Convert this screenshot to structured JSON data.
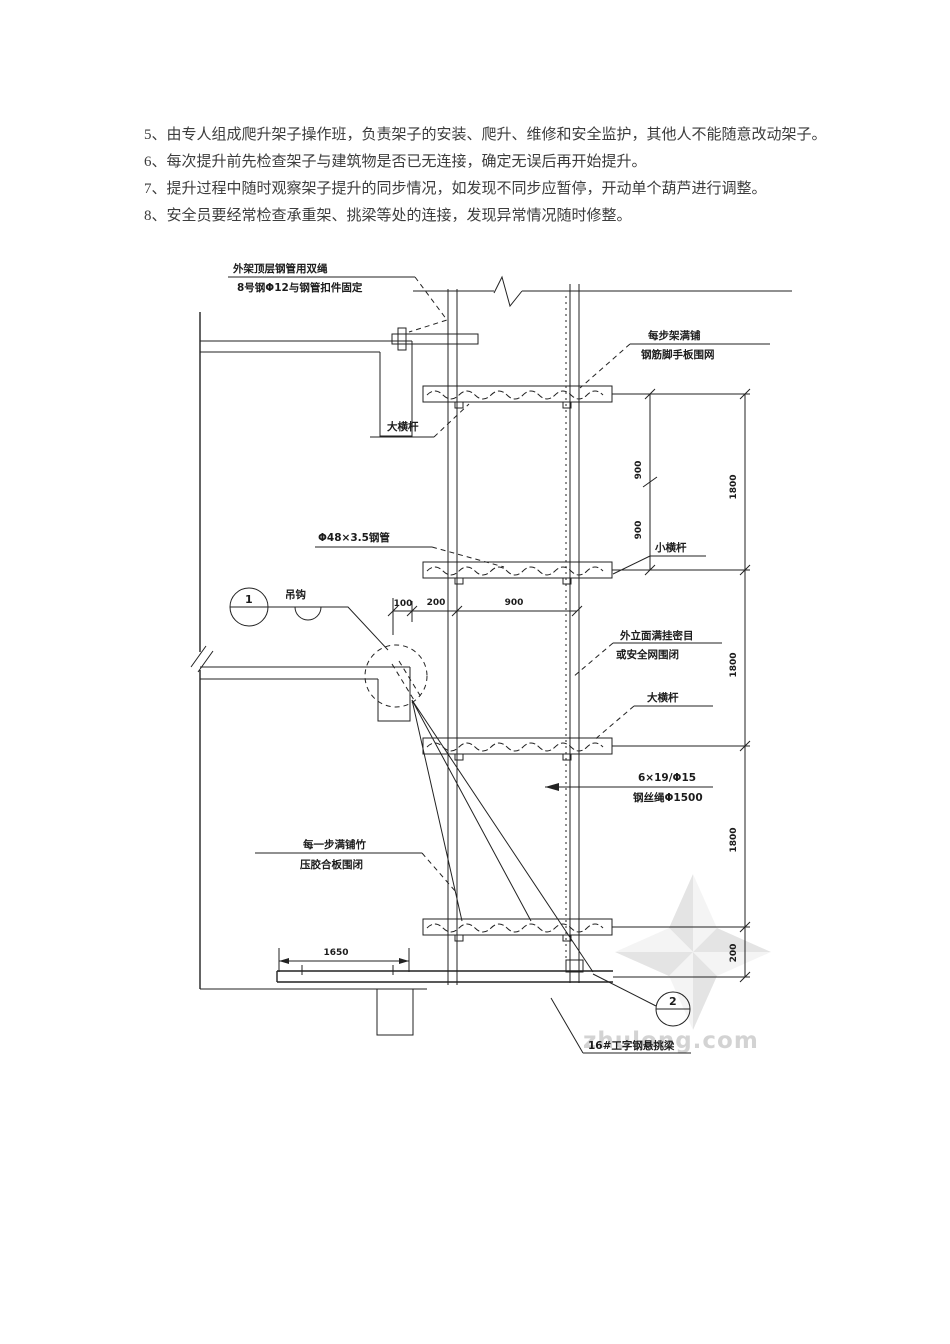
{
  "document": {
    "paragraphs": [
      "5、由专人组成爬升架子操作班，负责架子的安装、爬升、维修和安全监护，其他人不能随意改动架子。",
      "6、每次提升前先检查架子与建筑物是否已无连接，确定无误后再开始提升。",
      "7、提升过程中随时观察架子提升的同步情况，如发现不同步应暂停，开动单个葫芦进行调整。",
      "8、安全员要经常检查承重架、挑梁等处的连接，发现异常情况随时修整。"
    ]
  },
  "drawing": {
    "notes": {
      "anchor_l1": "外架顶层钢管用双绳",
      "anchor_l2": "8号钢Φ12与钢管扣件固定",
      "deck_l1": "每步架满铺",
      "deck_l2": "钢筋脚手板围网",
      "big_ledger": "大横杆",
      "pipe": "Φ48×3.5钢管",
      "hook": "吊钩",
      "small_ledger": "小横杆",
      "facade_l1": "外立面满挂密目",
      "facade_l2": "或安全网围闭",
      "big_ledger2": "大横杆",
      "rope_l1": "6×19/Φ15",
      "rope_l2": "钢丝绳Φ1500",
      "ply_l1": "每一步满铺竹",
      "ply_l2": "压胶合板围闭",
      "beam": "16#工字钢悬挑梁"
    },
    "dimensions": {
      "left_a": "900",
      "left_b": "900",
      "right_a": "1800",
      "right_b": "1800",
      "right_c": "1800",
      "right_d": "200",
      "h_a": "100",
      "h_b": "200",
      "h_c": "900",
      "bottom": "1650"
    },
    "callouts": {
      "one": "1",
      "two": "2"
    },
    "watermark": "zhulong.com",
    "colors": {
      "line": "#222222",
      "watermark": "#c9c9c9"
    }
  }
}
